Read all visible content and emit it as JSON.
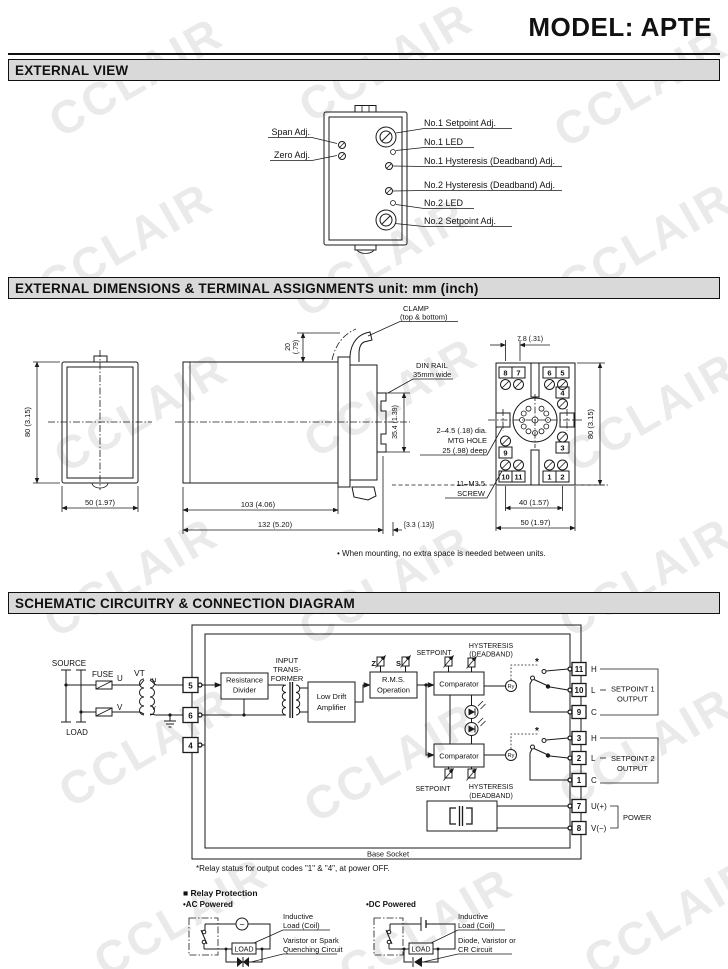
{
  "page": {
    "title": "MODEL: APTE",
    "watermark": "CCLAIR"
  },
  "bars": {
    "s1": "EXTERNAL VIEW",
    "s2": "EXTERNAL DIMENSIONS & TERMINAL ASSIGNMENTS unit: mm (inch)",
    "s3": "SCHEMATIC CIRCUITRY & CONNECTION DIAGRAM"
  },
  "ext": {
    "left": [
      "Span Adj.",
      "Zero Adj."
    ],
    "right": [
      "No.1 Setpoint Adj.",
      "No.1 LED",
      "No.1 Hysteresis (Deadband) Adj.",
      "No.2 Hysteresis (Deadband) Adj.",
      "No.2 LED",
      "No.2 Setpoint Adj."
    ]
  },
  "dims": {
    "front": {
      "h": "80 (3.15)",
      "w": "50 (1.97)"
    },
    "side": {
      "clamp1": "CLAMP",
      "clamp2": "(top & bottom)",
      "t20": "20",
      "t20i": "(.79)",
      "rail1": "DIN RAIL",
      "rail2": "35mm wide",
      "railh": "35.4 (1.39)",
      "d103": "103 (4.06)",
      "d132": "132 (5.20)",
      "d33": "[3.3 (.13)]"
    },
    "socket": {
      "pitch": "7.8 (.31)",
      "h": "80 (3.15)",
      "w40": "40 (1.57)",
      "w50": "50 (1.97)",
      "mtg1": "2–4.5 (.18) dia.",
      "mtg2": "MTG HOLE",
      "mtg3": "25 (.98) deep",
      "scr1": "11–M3.5",
      "scr2": "SCREW",
      "top": [
        "8",
        "7",
        "6",
        "5"
      ],
      "n4": "4",
      "n3": "3",
      "n9": "9",
      "bottom": [
        "10",
        "11",
        "1",
        "2"
      ]
    },
    "note": "• When mounting, no extra space is needed between units."
  },
  "sch": {
    "source": "SOURCE",
    "load": "LOAD",
    "fuse": "FUSE",
    "vt": "VT",
    "U": "U",
    "V": "V",
    "u": "u",
    "v": "v",
    "t5": "5",
    "t6": "6",
    "t4": "4",
    "rd1": "Resistance",
    "rd2": "Divider",
    "it1": "INPUT",
    "it2": "TRANS-",
    "it3": "FORMER",
    "lda1": "Low Drift",
    "lda2": "Amplifier",
    "rms1": "R.M.S.",
    "rms2": "Operation",
    "z": "Z",
    "s": "S",
    "sp": "SETPOINT",
    "hy1": "HYSTERESIS",
    "hy2": "(DEADBAND)",
    "comp": "Comparator",
    "ry": "Ry",
    "star": "*",
    "terms": [
      {
        "n": "11",
        "l": "H"
      },
      {
        "n": "10",
        "l": "L"
      },
      {
        "n": "9",
        "l": "C"
      },
      {
        "n": "3",
        "l": "H"
      },
      {
        "n": "2",
        "l": "L"
      },
      {
        "n": "1",
        "l": "C"
      },
      {
        "n": "7",
        "l": "U(+)"
      },
      {
        "n": "8",
        "l": "V(−)"
      }
    ],
    "g1a": "SETPOINT 1",
    "g1b": "OUTPUT",
    "g2a": "SETPOINT 2",
    "g2b": "OUTPUT",
    "g3": "POWER",
    "base": "Base Socket",
    "note": "*Relay status for output codes \"1\" & \"4\", at power OFF."
  },
  "rp": {
    "title": "■ Relay Protection",
    "ac": "•AC Powered",
    "dc": "•DC Powered",
    "load": "LOAD",
    "wave": "~",
    "ind1": "Inductive",
    "ind2": "Load (Coil)",
    "var1": "Varistor or Spark",
    "var2": "Quenching Circuit",
    "di1": "Diode, Varistor or",
    "di2": "CR Circuit"
  }
}
